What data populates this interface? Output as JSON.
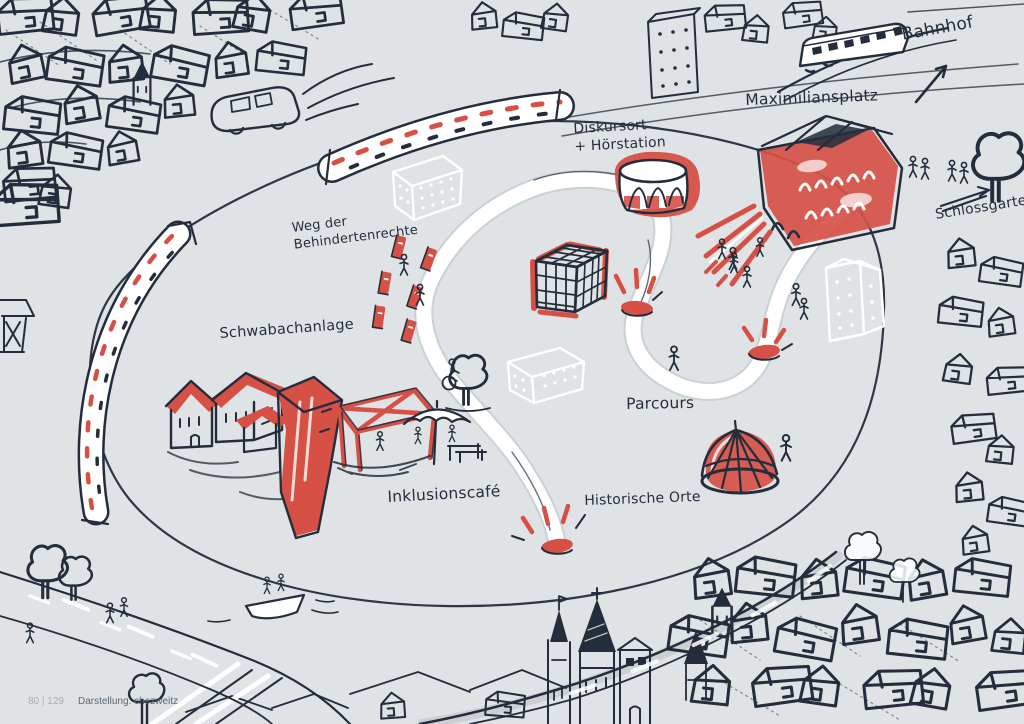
{
  "labels": {
    "bahnhof": "Bahnhof",
    "maximiliansplatz": "Maximiliansplatz",
    "schlossgarten": "Schlossgarten",
    "diskursort": "Diskursort\n+ Hörstation",
    "weg_der_behindertenrechte": "Weg der\nBehindertenrechte",
    "schwabachanlage": "Schwabachanlage",
    "inklusionscafe": "Inklusionscafé",
    "historische_orte": "Historische Orte",
    "parcours": "Parcours"
  },
  "footer": {
    "page_number": "80 | 129",
    "credit": "Darstellung: chezweitz"
  },
  "colors": {
    "bg": "#dfe3e5",
    "ink": "#232d3c",
    "red": "#d65046",
    "paper": "#ffffff",
    "footer": "#5b6872",
    "pagenum": "#a6aeb4"
  },
  "sketch_elements": [
    "city-sketch-top-left",
    "bus-sketch",
    "city-sketch-top-edge",
    "train-sketch",
    "bahnhof-arrow",
    "schlossgarten-arrow",
    "tree-sketch-top-right",
    "city-sketch-right",
    "city-sketch-bottom-right",
    "church-skyline",
    "river-and-boat",
    "road-sketch-bottom",
    "island-outline",
    "s-path",
    "wall-band-top",
    "wall-band-left",
    "ghost-buildings",
    "rotunda-diskursort",
    "cage-cube",
    "maximiliansplatz-building",
    "red-rays",
    "schwabachanlage-houses",
    "inklusionscafe-pavilion",
    "umbrella-and-table",
    "dome-tent",
    "disability-rights-posts",
    "path-markers",
    "stick-figures",
    "wheelchair-figure"
  ]
}
